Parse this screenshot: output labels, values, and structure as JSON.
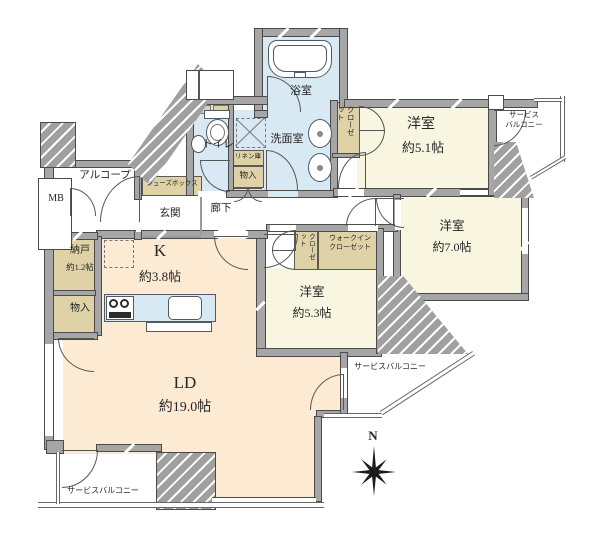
{
  "colors": {
    "room_cream": "#f8f5e0",
    "room_peach": "#fcead2",
    "closet_tan": "#ded2a6",
    "wet_blue": "#d9e9f4",
    "wall_gray": "#a6a6a6",
    "line": "#4a4a4a"
  },
  "labels": {
    "bathroom": "浴室",
    "washroom": "洗面室",
    "toilet": "トイレ",
    "linen": "リネン庫",
    "storage_wash": "物入",
    "closet_51": "クローゼット",
    "bedroom_51_name": "洋室",
    "bedroom_51_size": "約5.1帖",
    "balcony_tr": "サービス\nバルコニー",
    "corridor": "廊下",
    "entrance": "玄関",
    "shoe_box": "シューズボックス",
    "alcove": "アルコープ",
    "meter_box": "MB",
    "nando_name": "納戸",
    "nando_size": "約1.2帖",
    "storage_left": "物入",
    "kitchen_name": "K",
    "kitchen_size": "約3.8帖",
    "wic": "ウォークイン\nクローゼット",
    "closet_53": "クローゼット",
    "bedroom_53_name": "洋室",
    "bedroom_53_size": "約5.3帖",
    "bedroom_70_name": "洋室",
    "bedroom_70_size": "約7.0帖",
    "balcony_mid": "サービスバルコニー",
    "ld_name": "LD",
    "ld_size": "約19.0帖",
    "balcony_bl": "サービスバルコニー",
    "compass_north": "N"
  }
}
